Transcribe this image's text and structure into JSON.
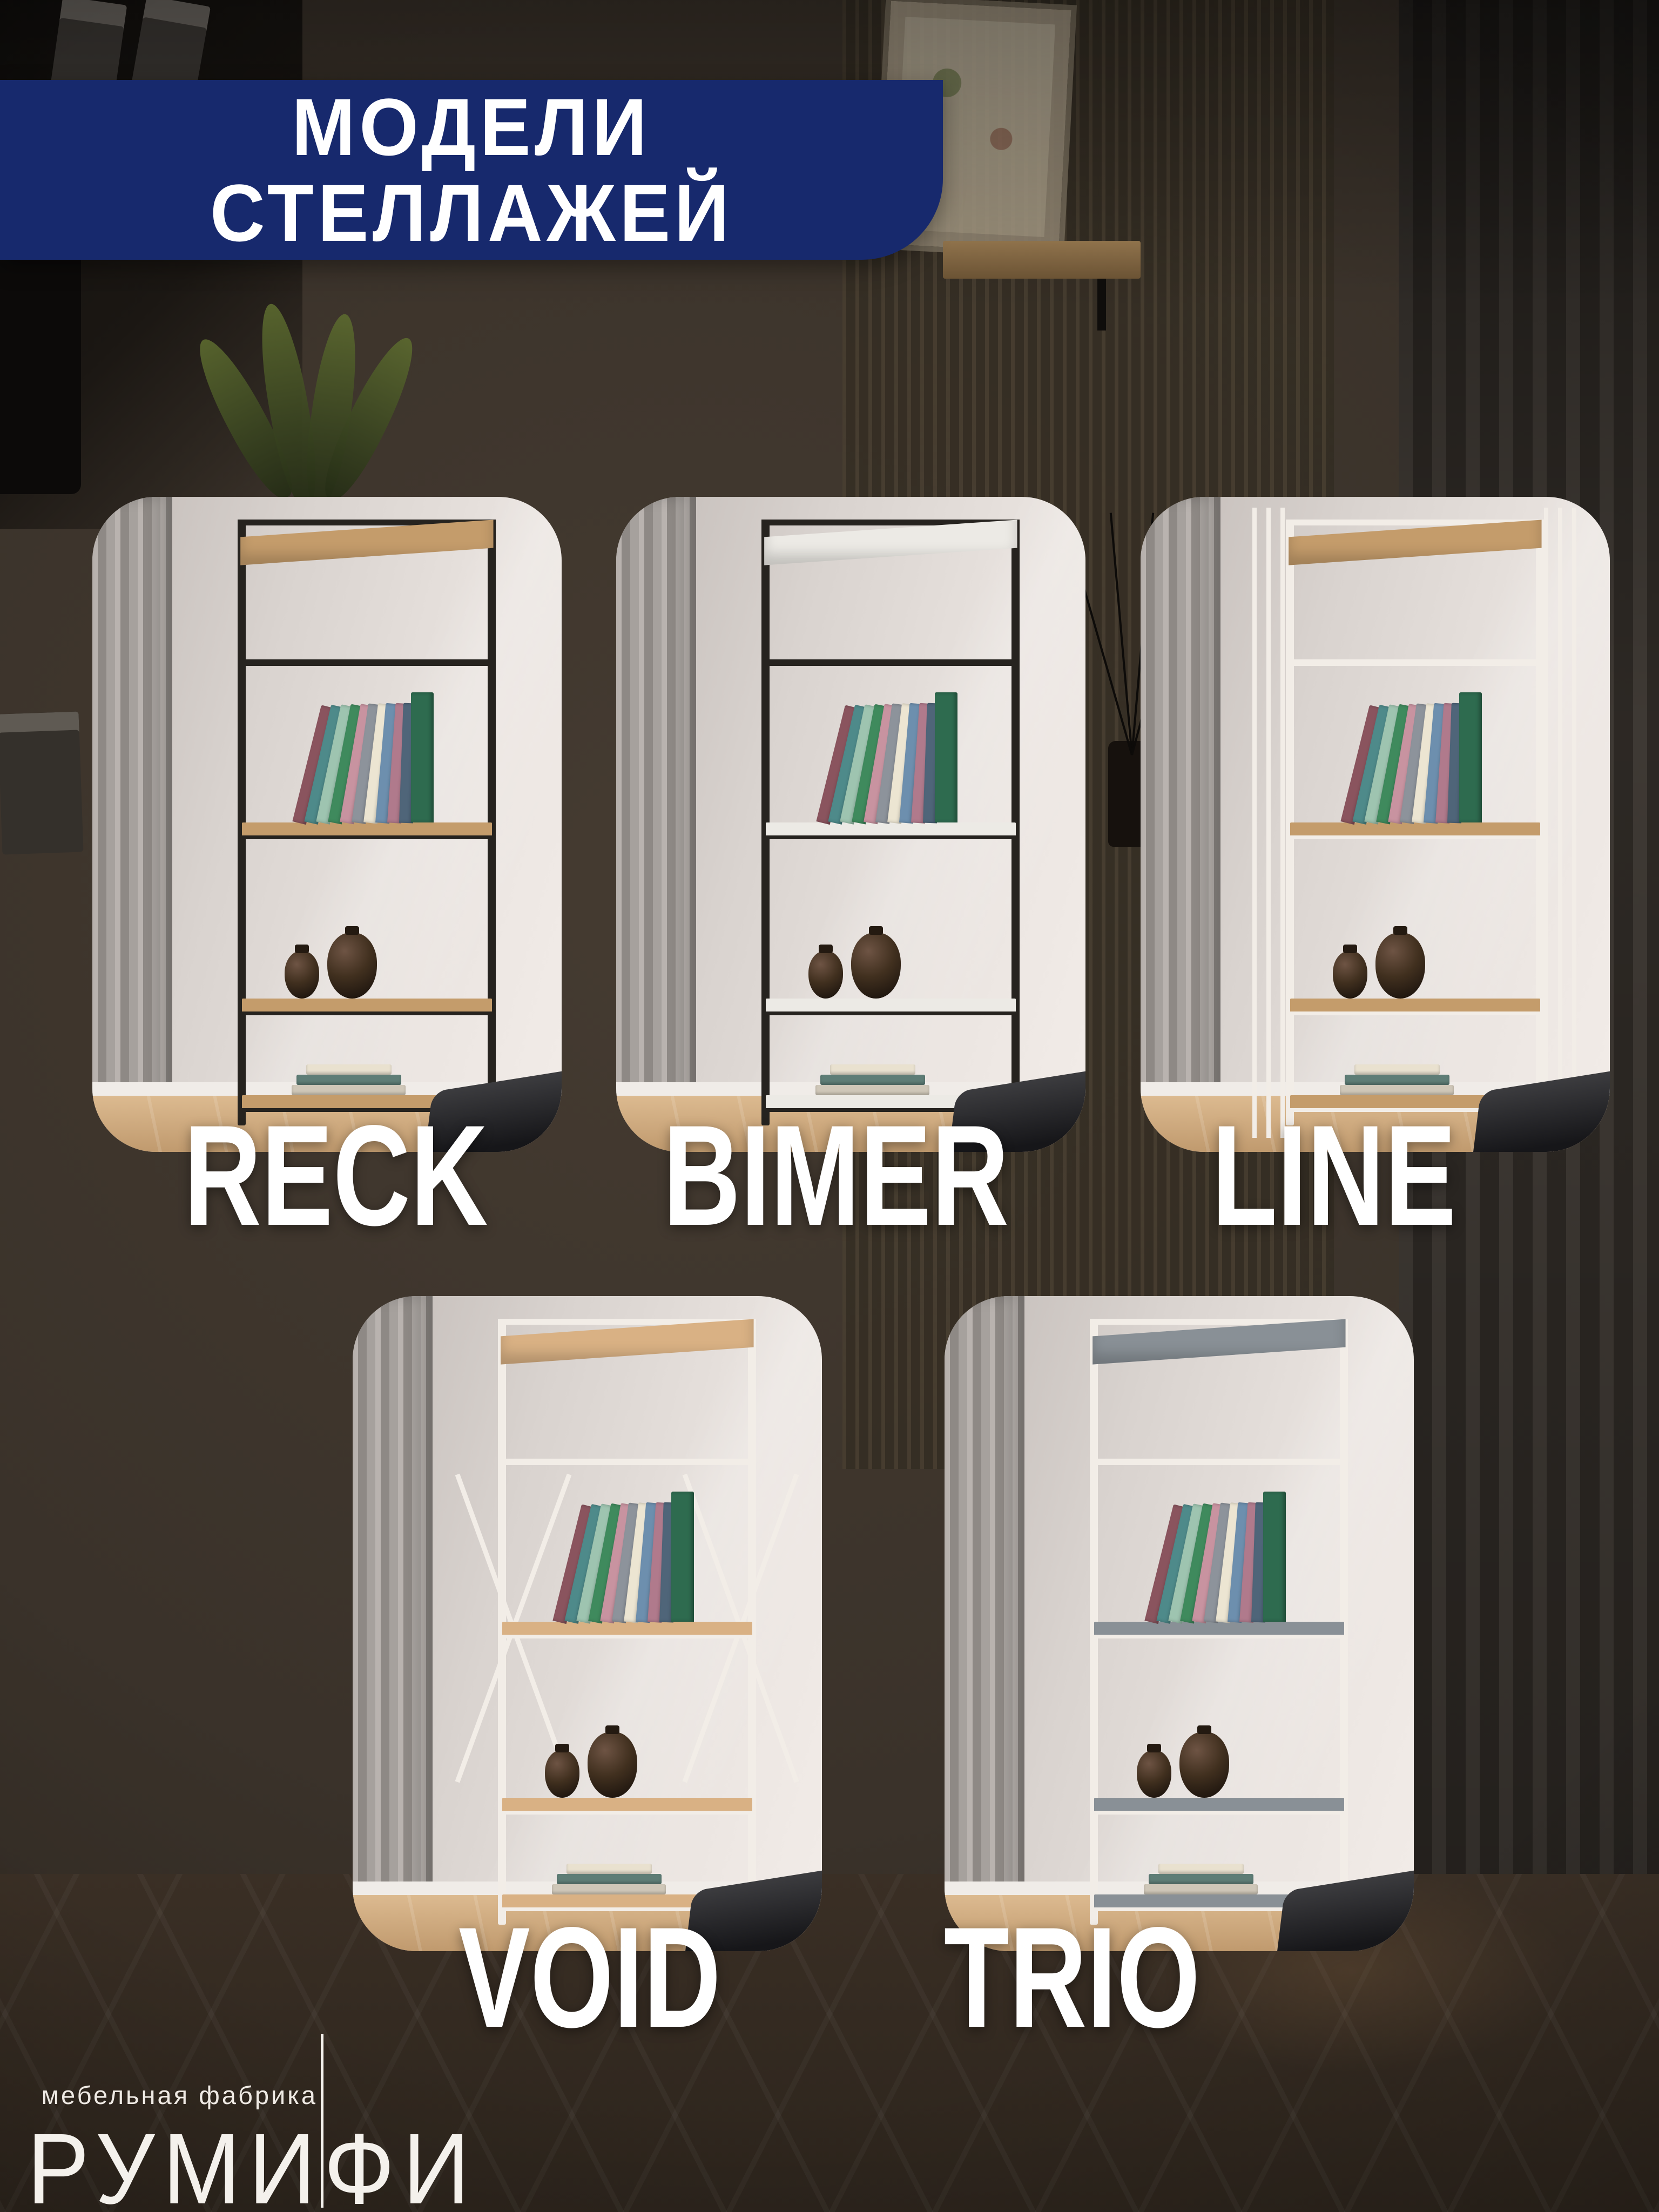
{
  "header": {
    "line1": "МОДЕЛИ",
    "line2": "СТЕЛЛАЖЕЙ",
    "banner_color": "#17296d",
    "text_color": "#ffffff"
  },
  "models": [
    {
      "name": "RECK",
      "frame_color": "#26231f",
      "shelf_color": "#c49c6b"
    },
    {
      "name": "BIMER",
      "frame_color": "#26231f",
      "shelf_color": "#eceae5"
    },
    {
      "name": "LINE",
      "frame_color": "#f2ede7",
      "shelf_color": "#c49c6b"
    },
    {
      "name": "VOID",
      "frame_color": "#f2ede7",
      "shelf_color": "#d9b184"
    },
    {
      "name": "TRIO",
      "frame_color": "#f2ede7",
      "shelf_color": "#899096"
    }
  ],
  "logo": {
    "tagline": "мебельная фабрика",
    "brand": "РУМИФИ"
  },
  "scene": {
    "background_color": "#2b241d",
    "label_color": "#ffffff"
  }
}
